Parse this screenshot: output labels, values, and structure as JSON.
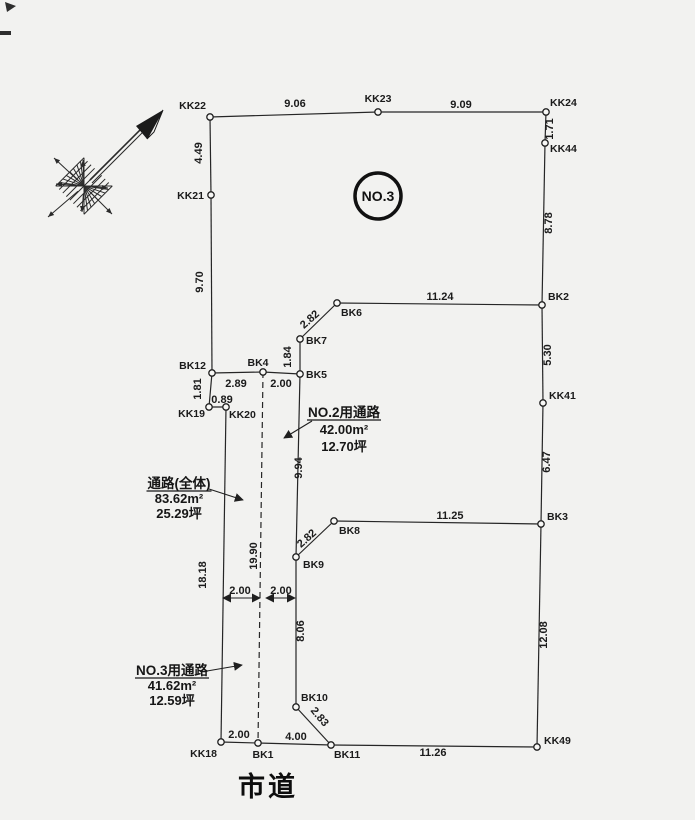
{
  "title": {
    "parcel_label": "NO.3",
    "road_label": "市道"
  },
  "colors": {
    "ink": "#1f1f1f",
    "paper": "#f2f2f0"
  },
  "diagram": {
    "parcel_circle": {
      "cx": 378,
      "cy": 196,
      "r": 23
    },
    "road_label_pos": {
      "x": 268,
      "y": 796
    },
    "points": [
      {
        "id": "KK22",
        "x": 210,
        "y": 117,
        "anchor": "end",
        "lx": 206,
        "ly": 109
      },
      {
        "id": "KK23",
        "x": 378,
        "y": 112,
        "anchor": "middle",
        "lx": 378,
        "ly": 102
      },
      {
        "id": "KK24",
        "x": 546,
        "y": 112,
        "anchor": "start",
        "lx": 550,
        "ly": 106
      },
      {
        "id": "KK44",
        "x": 545,
        "y": 143,
        "anchor": "start",
        "lx": 550,
        "ly": 152
      },
      {
        "id": "KK21",
        "x": 211,
        "y": 195,
        "anchor": "end",
        "lx": 204,
        "ly": 199
      },
      {
        "id": "BK12",
        "x": 212,
        "y": 373,
        "anchor": "end",
        "lx": 206,
        "ly": 369
      },
      {
        "id": "BK4",
        "x": 263,
        "y": 372,
        "anchor": "middle",
        "lx": 258,
        "ly": 366
      },
      {
        "id": "BK5",
        "x": 300,
        "y": 374,
        "anchor": "start",
        "lx": 306,
        "ly": 378
      },
      {
        "id": "BK7",
        "x": 300,
        "y": 339,
        "anchor": "start",
        "lx": 306,
        "ly": 344
      },
      {
        "id": "BK6",
        "x": 337,
        "y": 303,
        "anchor": "start",
        "lx": 341,
        "ly": 316
      },
      {
        "id": "BK2",
        "x": 542,
        "y": 305,
        "anchor": "start",
        "lx": 548,
        "ly": 300
      },
      {
        "id": "KK41",
        "x": 543,
        "y": 403,
        "anchor": "start",
        "lx": 549,
        "ly": 399
      },
      {
        "id": "BK3",
        "x": 541,
        "y": 524,
        "anchor": "start",
        "lx": 547,
        "ly": 520
      },
      {
        "id": "BK8",
        "x": 334,
        "y": 521,
        "anchor": "start",
        "lx": 339,
        "ly": 534
      },
      {
        "id": "BK9",
        "x": 296,
        "y": 557,
        "anchor": "start",
        "lx": 303,
        "ly": 568
      },
      {
        "id": "BK10",
        "x": 296,
        "y": 707,
        "anchor": "start",
        "lx": 301,
        "ly": 701
      },
      {
        "id": "BK11",
        "x": 331,
        "y": 745,
        "anchor": "start",
        "lx": 334,
        "ly": 758
      },
      {
        "id": "BK1",
        "x": 258,
        "y": 743,
        "anchor": "middle",
        "lx": 263,
        "ly": 758
      },
      {
        "id": "KK18",
        "x": 221,
        "y": 742,
        "anchor": "end",
        "lx": 217,
        "ly": 757
      },
      {
        "id": "KK19",
        "x": 209,
        "y": 407,
        "anchor": "end",
        "lx": 205,
        "ly": 417
      },
      {
        "id": "KK20",
        "x": 226,
        "y": 407,
        "anchor": "start",
        "lx": 229,
        "ly": 418
      },
      {
        "id": "KK49",
        "x": 537,
        "y": 747,
        "anchor": "start",
        "lx": 544,
        "ly": 744
      }
    ],
    "edges": [
      {
        "a": "KK22",
        "b": "KK23",
        "dashed": false
      },
      {
        "a": "KK23",
        "b": "KK24",
        "dashed": false
      },
      {
        "a": "KK24",
        "b": "KK44",
        "dashed": false
      },
      {
        "a": "KK44",
        "b": "BK2",
        "dashed": false
      },
      {
        "a": "BK2",
        "b": "KK41",
        "dashed": false
      },
      {
        "a": "KK41",
        "b": "BK3",
        "dashed": false
      },
      {
        "a": "BK3",
        "b": "KK49",
        "dashed": false
      },
      {
        "a": "KK22",
        "b": "KK21",
        "dashed": false
      },
      {
        "a": "KK21",
        "b": "BK12",
        "dashed": false
      },
      {
        "a": "BK12",
        "b": "BK4",
        "dashed": false
      },
      {
        "a": "BK4",
        "b": "BK5",
        "dashed": false
      },
      {
        "a": "BK5",
        "b": "BK7",
        "dashed": false
      },
      {
        "a": "BK7",
        "b": "BK6",
        "dashed": false
      },
      {
        "a": "BK6",
        "b": "BK2",
        "dashed": false
      },
      {
        "a": "BK12",
        "b": "KK19",
        "dashed": false
      },
      {
        "a": "KK19",
        "b": "KK20",
        "dashed": false
      },
      {
        "a": "KK20",
        "b": "KK18",
        "dashed": false
      },
      {
        "a": "BK5",
        "b": "BK9",
        "dashed": false
      },
      {
        "a": "BK9",
        "b": "BK8",
        "dashed": false
      },
      {
        "a": "BK8",
        "b": "BK3",
        "dashed": false
      },
      {
        "a": "BK9",
        "b": "BK10",
        "dashed": false
      },
      {
        "a": "BK10",
        "b": "BK11",
        "dashed": false
      },
      {
        "a": "KK18",
        "b": "BK1",
        "dashed": false
      },
      {
        "a": "BK1",
        "b": "BK11",
        "dashed": false
      },
      {
        "a": "BK11",
        "b": "KK49",
        "dashed": false
      },
      {
        "a": "BK4",
        "b": "BK1",
        "dashed": true
      }
    ],
    "dims": [
      {
        "text": "9.06",
        "x": 295,
        "y": 107,
        "rot": 0
      },
      {
        "text": "9.09",
        "x": 461,
        "y": 108,
        "rot": 0
      },
      {
        "text": "4.49",
        "x": 202,
        "y": 153,
        "rot": -90
      },
      {
        "text": "1.71",
        "x": 553,
        "y": 129,
        "rot": -90
      },
      {
        "text": "8.78",
        "x": 552,
        "y": 223,
        "rot": -90
      },
      {
        "text": "9.70",
        "x": 203,
        "y": 282,
        "rot": -90
      },
      {
        "text": "11.24",
        "x": 440,
        "y": 300,
        "rot": 0
      },
      {
        "text": "2.82",
        "x": 312,
        "y": 322,
        "rot": -42
      },
      {
        "text": "1.84",
        "x": 291,
        "y": 357,
        "rot": -90
      },
      {
        "text": "2.89",
        "x": 236,
        "y": 387,
        "rot": 0
      },
      {
        "text": "2.00",
        "x": 281,
        "y": 387,
        "rot": 0
      },
      {
        "text": "1.81",
        "x": 201,
        "y": 389,
        "rot": -90
      },
      {
        "text": "0.89",
        "x": 222,
        "y": 403,
        "rot": 0
      },
      {
        "text": "5.30",
        "x": 551,
        "y": 355,
        "rot": -90
      },
      {
        "text": "9.94",
        "x": 302,
        "y": 468,
        "rot": -90
      },
      {
        "text": "6.47",
        "x": 550,
        "y": 462,
        "rot": -90
      },
      {
        "text": "11.25",
        "x": 450,
        "y": 519,
        "rot": 0
      },
      {
        "text": "2.82",
        "x": 309,
        "y": 541,
        "rot": -42
      },
      {
        "text": "18.18",
        "x": 206,
        "y": 575,
        "rot": -90
      },
      {
        "text": "19.90",
        "x": 257,
        "y": 556,
        "rot": -90
      },
      {
        "text": "2.00",
        "x": 240,
        "y": 594,
        "rot": 0
      },
      {
        "text": "2.00",
        "x": 281,
        "y": 594,
        "rot": 0
      },
      {
        "text": "8.06",
        "x": 304,
        "y": 631,
        "rot": -90
      },
      {
        "text": "12.08",
        "x": 547,
        "y": 635,
        "rot": -90
      },
      {
        "text": "2.83",
        "x": 317,
        "y": 719,
        "rot": 50
      },
      {
        "text": "2.00",
        "x": 239,
        "y": 738,
        "rot": 0
      },
      {
        "text": "4.00",
        "x": 296,
        "y": 740,
        "rot": 0
      },
      {
        "text": "11.26",
        "x": 433,
        "y": 756,
        "rot": 0
      }
    ],
    "dim_arrows": [
      {
        "x1": 223,
        "y1": 598,
        "x2": 260,
        "y2": 598
      },
      {
        "x1": 266,
        "y1": 598,
        "x2": 295,
        "y2": 598
      }
    ],
    "area_labels": [
      {
        "title": "NO.2用通路",
        "area": "42.00m²",
        "tsubo": "12.70坪",
        "cx": 344,
        "ty": 417,
        "lh": 17,
        "leader": {
          "x1": 312,
          "y1": 421,
          "x2": 284,
          "y2": 438
        }
      },
      {
        "title": "通路(全体)",
        "area": "83.62m²",
        "tsubo": "25.29坪",
        "cx": 179,
        "ty": 488,
        "lh": 15,
        "leader": {
          "x1": 209,
          "y1": 489,
          "x2": 243,
          "y2": 500
        }
      },
      {
        "title": "NO.3用通路",
        "area": "41.62m²",
        "tsubo": "12.59坪",
        "cx": 172,
        "ty": 675,
        "lh": 15,
        "leader": {
          "x1": 207,
          "y1": 671,
          "x2": 242,
          "y2": 665
        }
      }
    ]
  }
}
